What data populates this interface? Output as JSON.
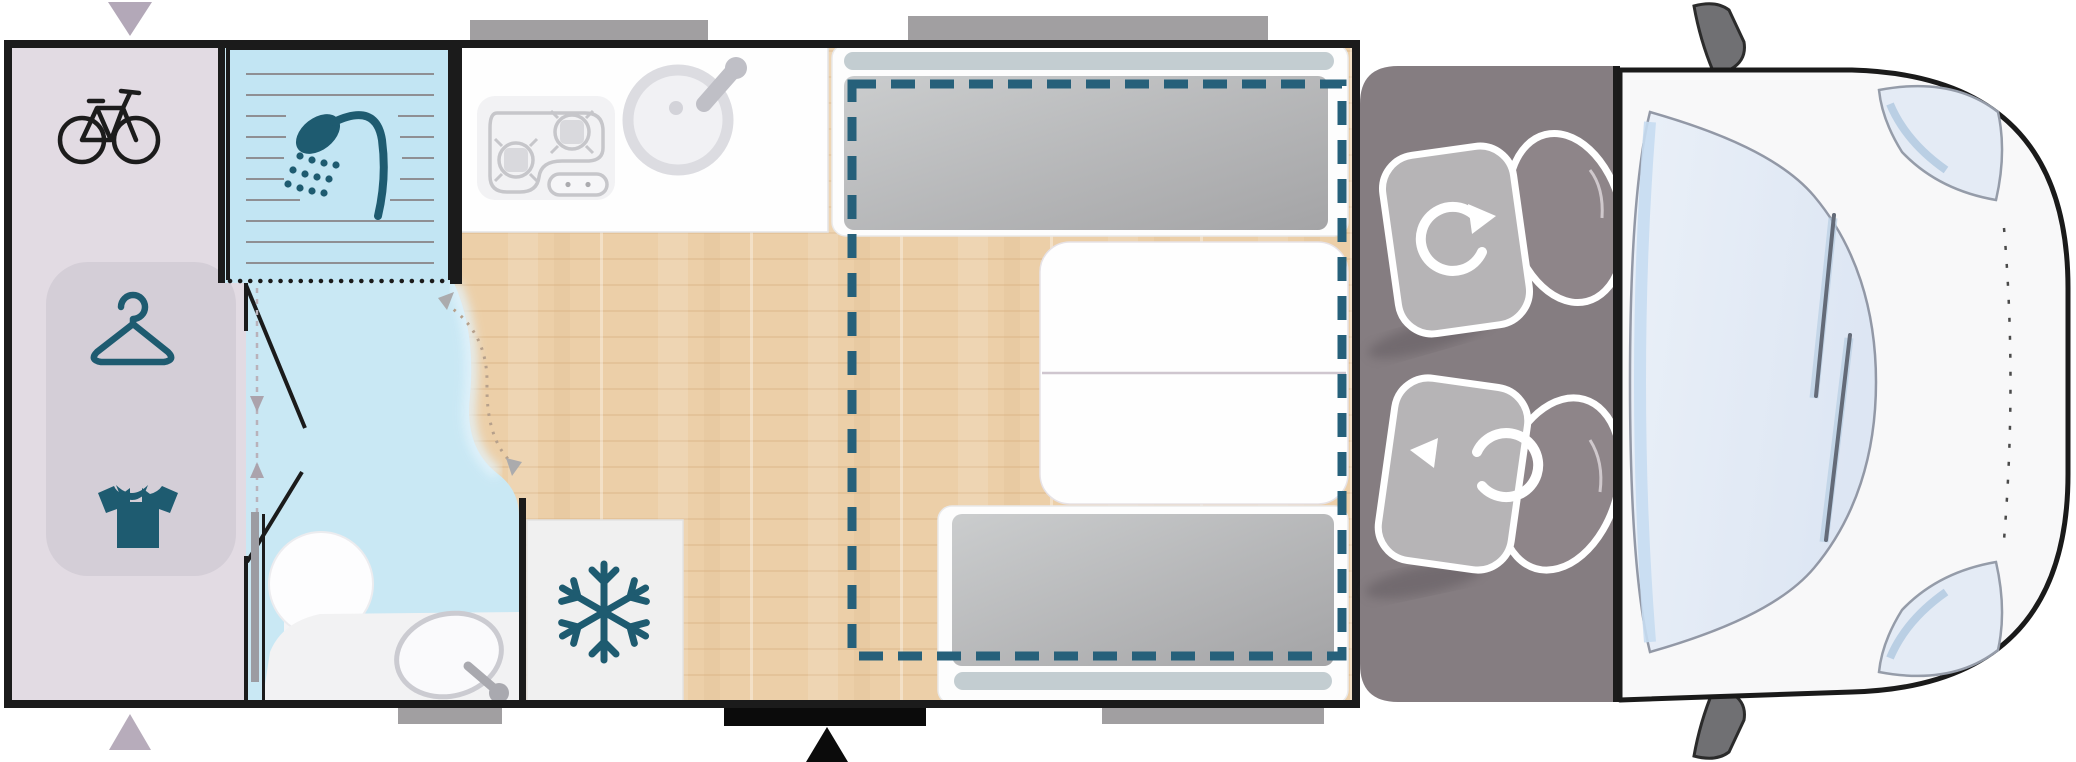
{
  "diagram": {
    "type": "motorhome-floorplan-top-view",
    "title": "campervan layout plan",
    "areas": [
      {
        "id": "rear-garage",
        "icons": [
          "bicycle-icon",
          "hanger-icon",
          "tshirt-icon"
        ],
        "fixtures": [
          "wardrobe-panel"
        ]
      },
      {
        "id": "bathroom",
        "icons": [
          "shower-icon"
        ],
        "fixtures": [
          "shower-tray",
          "toilet",
          "washbasin-counter",
          "sliding-door",
          "folding-door",
          "swivel-wall-arc"
        ]
      },
      {
        "id": "kitchen",
        "fixtures": [
          "two-burner-hob",
          "round-sink",
          "sliding-partition"
        ]
      },
      {
        "id": "refrigerator",
        "icons": [
          "snowflake-icon"
        ]
      },
      {
        "id": "dinette",
        "fixtures": [
          "front-bench",
          "rear-bench",
          "table",
          "drop-down-bed-dashed-outline"
        ]
      },
      {
        "id": "cab",
        "icons": [
          "rotate-cw-icon",
          "rotate-ccw-icon"
        ],
        "fixtures": [
          "driver-swivel-seat",
          "passenger-swivel-seat",
          "cab-floor"
        ]
      },
      {
        "id": "vehicle-front",
        "fixtures": [
          "windshield",
          "wiper-left",
          "wiper-right",
          "headlight-top",
          "headlight-bottom",
          "mirror-top",
          "mirror-bottom",
          "hood-dashed-line"
        ]
      }
    ],
    "markers": [
      "garage-arrow-top",
      "garage-arrow-bottom",
      "entry-door-step",
      "entry-arrow",
      "window-top-kitchen",
      "window-top-dinette",
      "window-bottom-bath",
      "window-bottom-dinette"
    ]
  },
  "colors": {
    "wall": "#1b1b1b",
    "lavender": "#e2dbe3",
    "panel": "#d4ced7",
    "bath": "#c9e8f4",
    "tray": "#c2e5f3",
    "teal": "#1e5b70",
    "tealdash": "#26607a",
    "wood": "#eccfa8",
    "woodseam": "#d9b488",
    "counter": "#fefefe",
    "graytool": "#c6c6ca",
    "window": "#a19fa1",
    "marker": "#b7acbb",
    "doorstep": "#0b0b0b",
    "pillow": "#c3cdd1",
    "cusha": "#cbcdce",
    "cushb": "#a4a4a6",
    "cabfloor": "#857d81",
    "seatcush": "#b6b4b6",
    "seatback": "#8e8589",
    "body": "#f8f8f9",
    "glass": "#e4ebf5",
    "glassedge": "#c6dcf1",
    "outline": "#9298a6",
    "mirror": "#707073",
    "slider": "#9c9ca2",
    "fridge": "#f0f0f0",
    "white": "#fdfdfd"
  }
}
